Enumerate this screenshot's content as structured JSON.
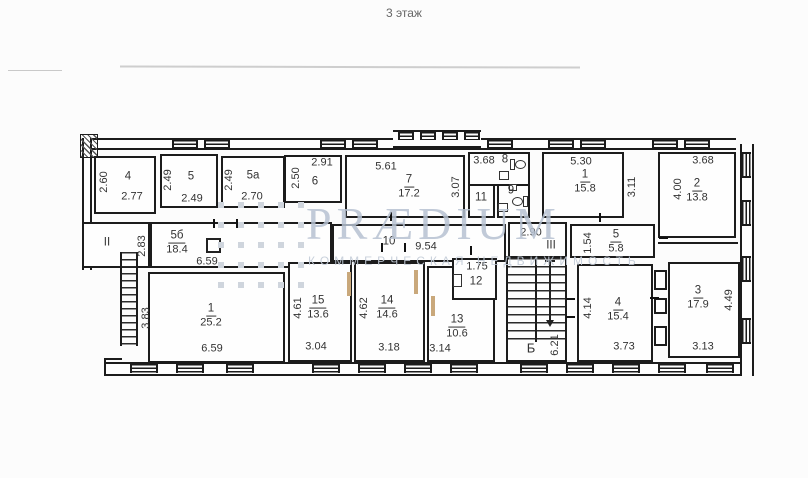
{
  "title": "3 этаж",
  "watermark": {
    "brand": "PRÆDIUM",
    "subtitle": "КОММЕРЧЕСКАЯ НЕДВИЖИМОСТЬ"
  },
  "colors": {
    "line": "#1c1c1c",
    "label": "#333333",
    "watermark": "#b7c2d2",
    "door": "#c9a87b"
  },
  "rooms": {
    "r4": {
      "num": "4",
      "w": "2.77",
      "h": "2.60"
    },
    "r5": {
      "num": "5",
      "w": "2.49",
      "h": "2.49"
    },
    "r5a": {
      "num": "5а",
      "w": "2.70",
      "h": "2.49"
    },
    "r6": {
      "num": "6",
      "w": "2.91",
      "h": "2.50"
    },
    "r7": {
      "num": "7",
      "area": "17.2",
      "w": "5.61",
      "h": "3.07"
    },
    "r8": {
      "num": "8",
      "w": "3.68"
    },
    "r9": {
      "num": "9"
    },
    "r11": {
      "num": "11"
    },
    "r1_top": {
      "num": "1",
      "area": "15.8",
      "w": "5.30",
      "h": "3.11"
    },
    "r2": {
      "num": "2",
      "area": "13.8",
      "w": "3.68",
      "h": "4.00"
    },
    "corr_II": {
      "num": "II"
    },
    "r5b": {
      "num": "5б",
      "area": "18.4",
      "w": "6.59",
      "h": "2.83"
    },
    "corr_10": {
      "num": "10",
      "w": "9.54"
    },
    "corr_III": {
      "num": "III",
      "w": "2.90"
    },
    "r5_mid": {
      "num": "5",
      "area": "5.8",
      "h": "1.54"
    },
    "r1_bot": {
      "num": "1",
      "area": "25.2",
      "w": "6.59",
      "h": "3.83"
    },
    "r15": {
      "num": "15",
      "area": "13.6",
      "w": "3.04",
      "h": "4.61"
    },
    "r14": {
      "num": "14",
      "area": "14.6",
      "w": "3.18",
      "h": "4.62"
    },
    "r13": {
      "num": "13",
      "area": "10.6",
      "w": "3.14"
    },
    "r12": {
      "num": "12",
      "w": "1.75"
    },
    "stair_B": {
      "num": "Б",
      "h": "6.21"
    },
    "r4_bot": {
      "num": "4",
      "area": "15.4",
      "w": "3.73",
      "h": "4.14"
    },
    "r3": {
      "num": "3",
      "area": "17.9",
      "w": "3.13",
      "h": "4.49"
    }
  }
}
